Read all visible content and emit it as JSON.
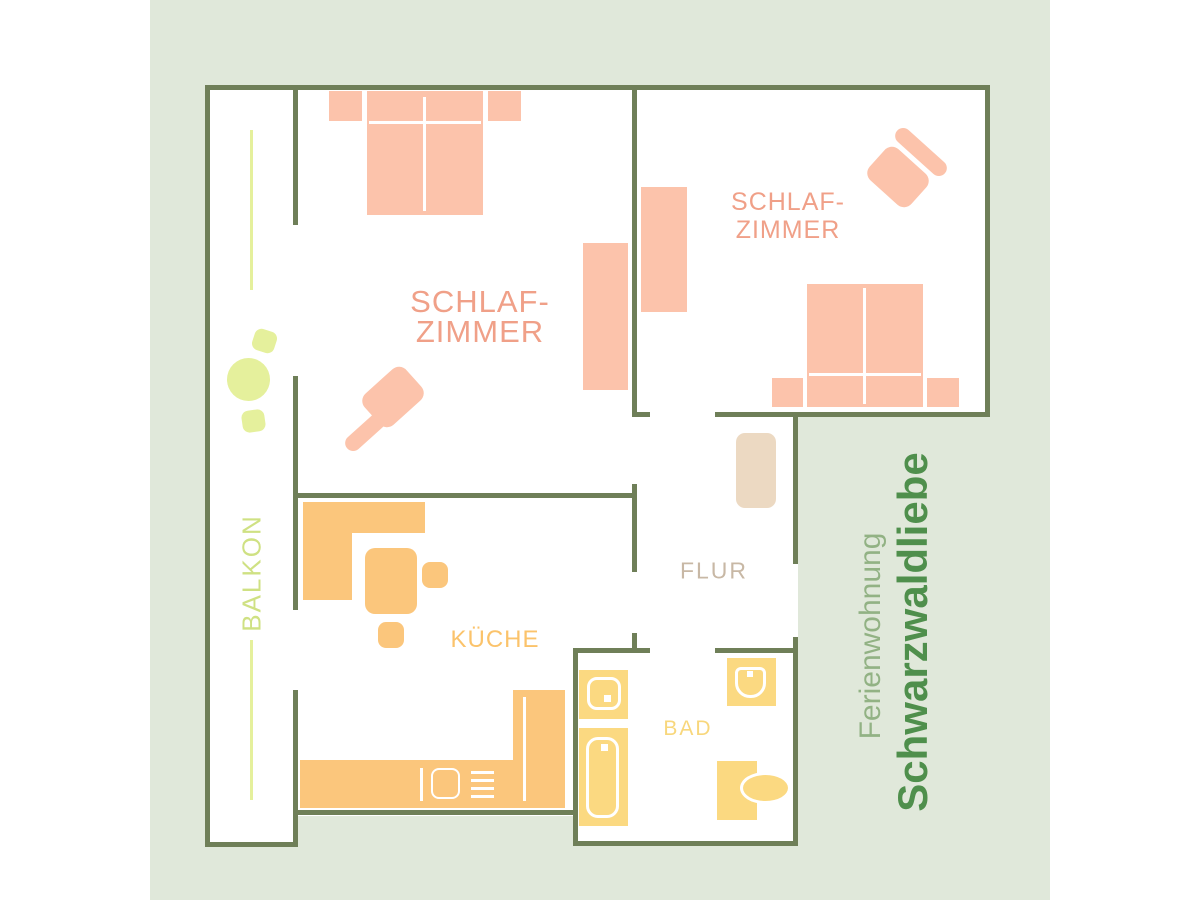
{
  "branding": {
    "subtitle": "Ferienwohnung",
    "title": "Schwarzwaldliebe"
  },
  "plan": {
    "bedroom1": {
      "label_line1": "SCHLAF-",
      "label_line2": "ZIMMER"
    },
    "bedroom2": {
      "label_line1": "SCHLAF-",
      "label_line2": "ZIMMER"
    },
    "kitchen": {
      "label": "KÜCHE"
    },
    "hall": {
      "label": "FLUR"
    },
    "bath": {
      "label": "BAD"
    },
    "balcony": {
      "label": "BALKON"
    }
  },
  "palette": {
    "margin_background": "#ffffff",
    "canvas_background": "#e0e8da",
    "wall": "#6f7f58",
    "floor": "#ffffff",
    "bedroom_furniture": "#fcc3ab",
    "bedroom_label": "#f0a088",
    "kitchen_furniture": "#fbc67c",
    "kitchen_label": "#fbc36b",
    "bath_furniture": "#fbd981",
    "bath_label": "#f8d77c",
    "hall_furniture": "#ecd9c2",
    "hall_label": "#c8b8a5",
    "balcony_furniture": "#e5f09c",
    "balcony_label": "#cfe183",
    "subtitle_color": "#92b284",
    "title_color": "#4f8f4c"
  }
}
